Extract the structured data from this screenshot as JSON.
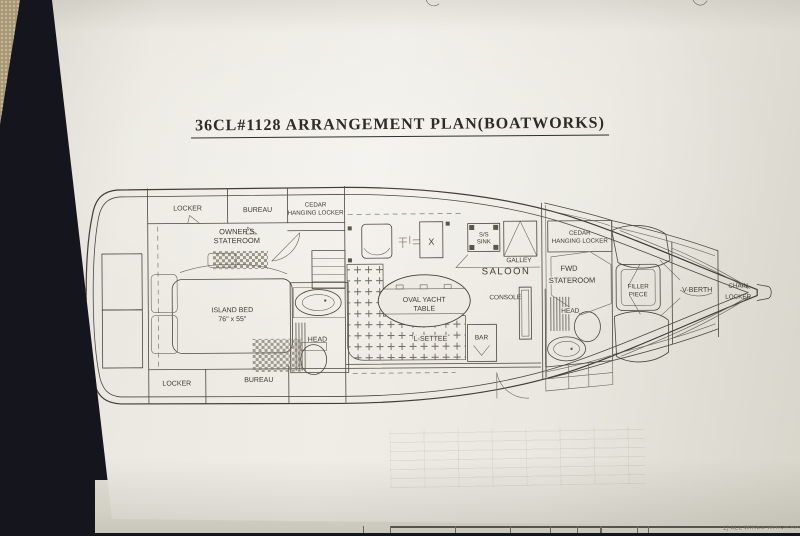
{
  "photo": {
    "carpet_color": "#a89878",
    "table_color": "#14151d",
    "under_sheet_text": "1) ALL WIRES WHICH ARE"
  },
  "document": {
    "title": "36CL#1128 ARRANGEMENT PLAN(BOATWORKS)",
    "paper_color": "#eae7df",
    "ink_color": "#45413a"
  },
  "plan": {
    "labels": {
      "locker_port": "LOCKER",
      "bureau_port": "BUREAU",
      "cedar_locker_aft_line1": "CEDAR",
      "cedar_locker_aft_line2": "HANGING LOCKER",
      "owners_stateroom_line1": "OWNER'S",
      "owners_stateroom_line2": "STATEROOM",
      "island_bed_line1": "ISLAND BED",
      "island_bed_line2": "76\" x 55\"",
      "locker_stbd": "LOCKER",
      "bureau_stbd": "BUREAU",
      "head_aft": "HEAD",
      "saloon": "SALOON",
      "oval_table_line1": "OVAL YACHT",
      "oval_table_line2": "TABLE",
      "l_settee": "L-SETTEE",
      "bar": "BAR",
      "console": "CONSOLE",
      "ss_sink_line1": "S/S",
      "ss_sink_line2": "SINK",
      "galley": "GALLEY",
      "hatch_x": "X",
      "cedar_locker_fwd_line1": "CEDAR",
      "cedar_locker_fwd_line2": "HANGING LOCKER",
      "fwd_stateroom_line1": "FWD",
      "fwd_stateroom_line2": "STATEROOM",
      "head_fwd": "HEAD",
      "filler_piece_line1": "FILLER",
      "filler_piece_line2": "PIECE",
      "v_berth": "V-BERTH",
      "chain_locker_line1": "CHAIN",
      "chain_locker_line2": "LOCKER"
    }
  }
}
